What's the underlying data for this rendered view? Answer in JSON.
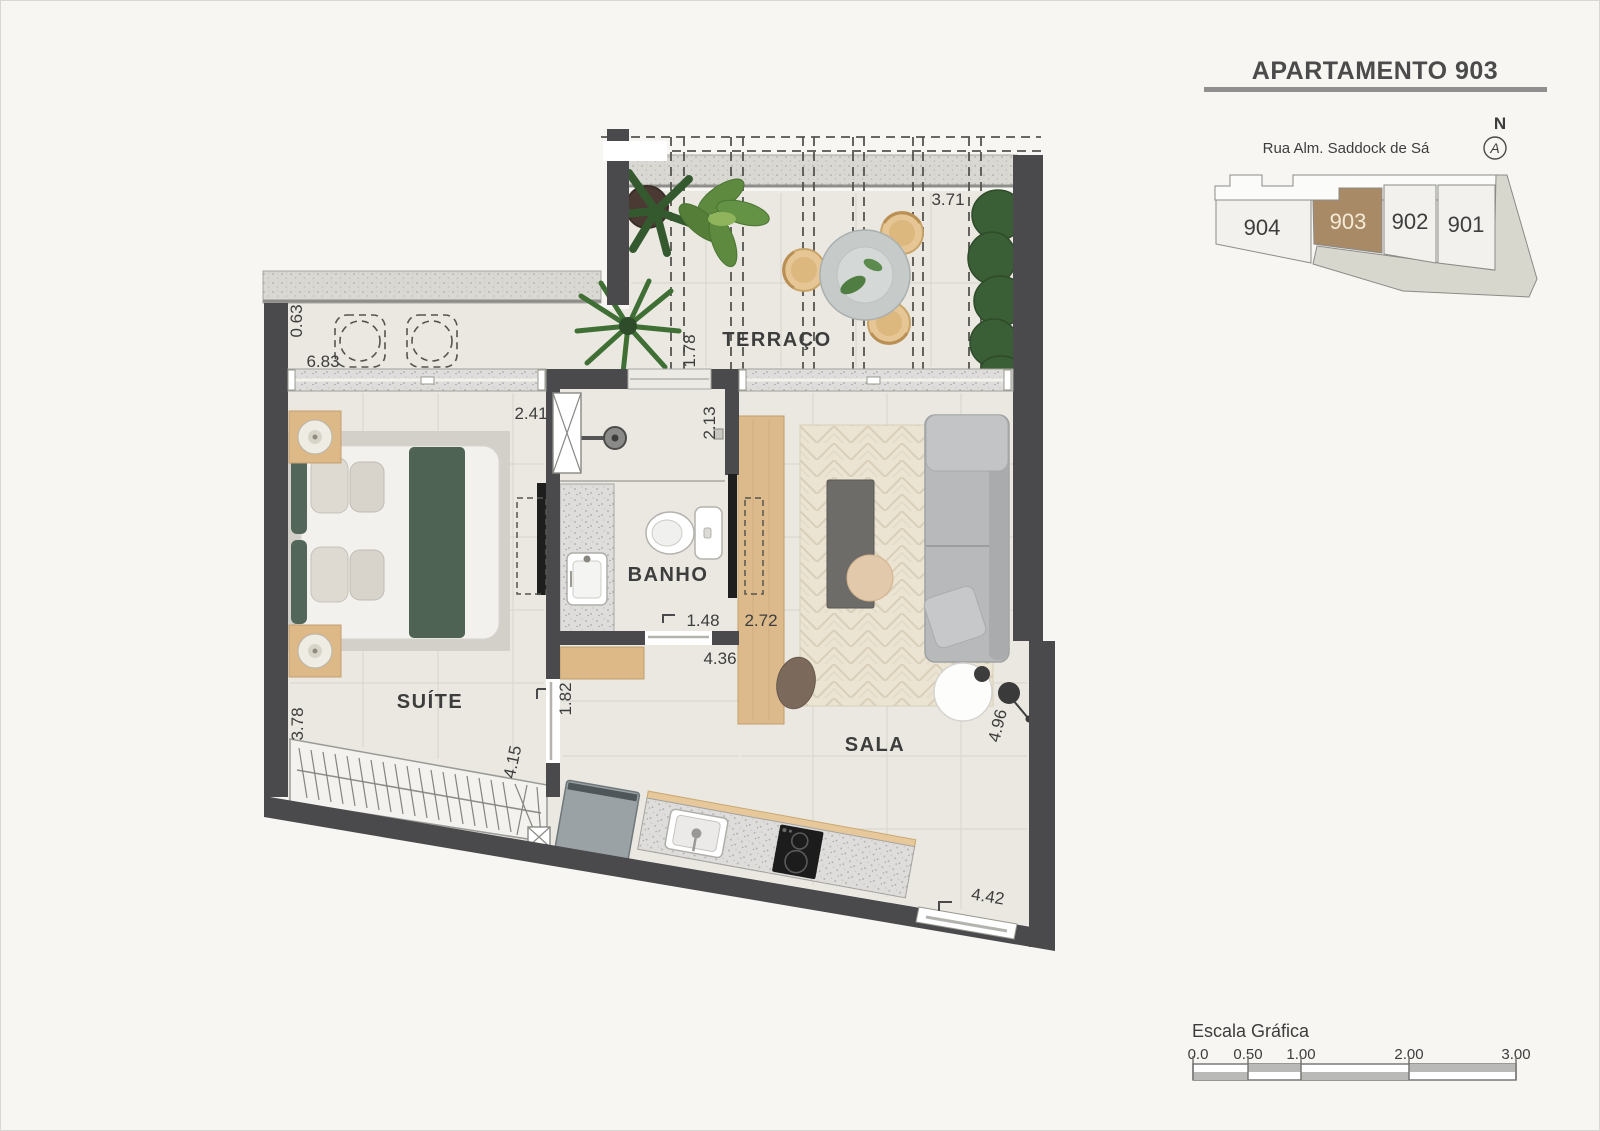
{
  "title": "APARTAMENTO 903",
  "keyplan": {
    "street": "Rua Alm. Saddock de Sá",
    "north_label": "N",
    "north_glyph": "A",
    "units": [
      {
        "id": "904",
        "highlighted": false
      },
      {
        "id": "903",
        "highlighted": true
      },
      {
        "id": "902",
        "highlighted": false
      },
      {
        "id": "901",
        "highlighted": false
      }
    ],
    "highlight_color": "#a98a67"
  },
  "plan": {
    "rooms": {
      "terrace": "TERRAÇO",
      "suite": "SUÍTE",
      "bath": "BANHO",
      "living": "SALA"
    },
    "dims": {
      "terrace_width": "3.71",
      "terrace_depth": "1.78",
      "balcony_depth": "0.63",
      "balcony_length": "6.83",
      "suite_width": "2.41",
      "bath_depth": "2.13",
      "bath_door": "1.48",
      "tv_panel": "2.72",
      "hall_length": "4.36",
      "suite_door": "1.82",
      "suite_depth": "3.78",
      "wardrobe_length": "4.15",
      "sala_depth": "4.96",
      "kitchen_front": "4.42"
    }
  },
  "scale_bar": {
    "label": "Escala Gráfica",
    "ticks": [
      "0.0",
      "0.50",
      "1.00",
      "2.00",
      "3.00"
    ]
  },
  "colors": {
    "wall": "#4a4a4c",
    "floor": "#eae8e1",
    "accent_wood": "#dcb987",
    "highlight": "#a98a67"
  }
}
